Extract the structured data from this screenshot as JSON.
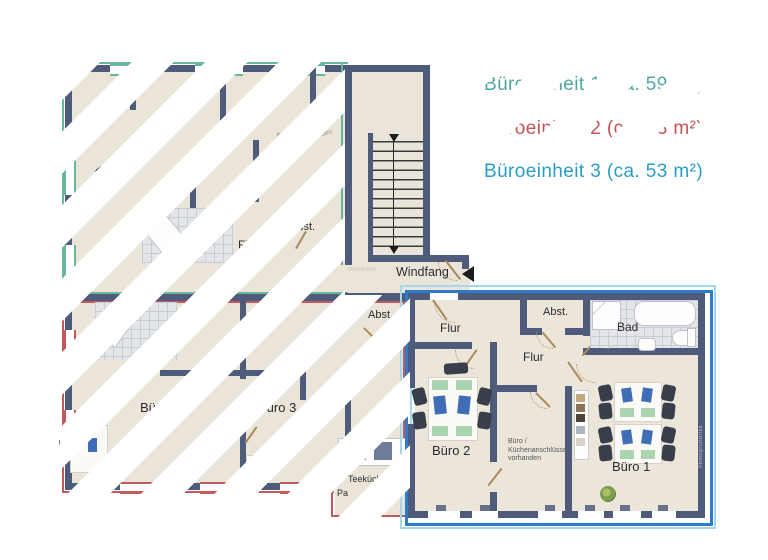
{
  "legend": {
    "items": [
      {
        "text": "Büroeinheit 1 (ca. 59 m²)",
        "color": "#4fa5a0",
        "hatched": true
      },
      {
        "text": "Büroeinheit 2 (ca. 63 m²)",
        "color": "#c25459",
        "hatched": true
      },
      {
        "text": "Büroeinheit 3 (ca. 53 m²)",
        "color": "#2b9dc4",
        "hatched": false
      }
    ]
  },
  "colors": {
    "unit1_outline": "#66b79c",
    "unit2_outline": "#c05a5e",
    "unit3_outline": "#2e7cc9",
    "wall": "#4f5b7a"
  },
  "plan": {
    "windfang": "Windfang",
    "watermark_small": "Immobilien",
    "unit3": {
      "flur_top": "Flur",
      "flur_mid": "Flur",
      "abst": "Abst.",
      "bad": "Bad",
      "buero1": "Büro 1",
      "buero2": "Büro 2",
      "note1": "Büro /",
      "note2": "Küchenanschlüsse",
      "note3": "vorhanden",
      "watermark_vertical": "Immogrundriss"
    },
    "left": {
      "bad": "Bad",
      "flur": "Flur",
      "abst_upper": "Abst.",
      "abst_lower": "Abst.",
      "buero4": "Büro 4",
      "buero3": "Büro 3",
      "teekueche": "Teeküche",
      "fragment_pa": "Pa",
      "fragment_n": "n",
      "note1": "Küchenanschlüsse",
      "note2": "vorhanden"
    }
  }
}
